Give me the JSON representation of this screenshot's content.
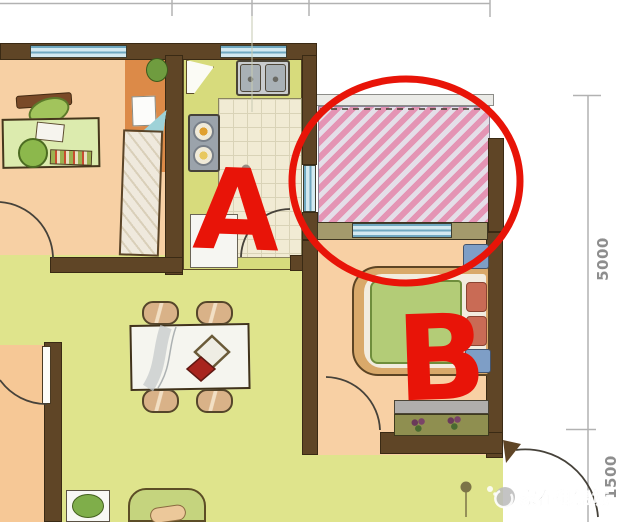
{
  "annotations": {
    "letter_a": "A",
    "letter_b": "B",
    "circle_color": "#e81408"
  },
  "dimensions": {
    "right_top": "5000",
    "right_bottom": "1500"
  },
  "watermark": {
    "icon": "camera-icon",
    "text": "家在御锦城"
  },
  "colors": {
    "wall_brown": "#5f4526",
    "window_blue": "#d3e9f0",
    "hatch_pink": "#e494b4",
    "study_floor": "#f7d0a4",
    "bedroom_floor": "#f8d0a4",
    "living_floor": "#dfe48c",
    "kitchen_counter": "#d7db7c",
    "annotation_red": "#e81408",
    "dimension_gray": "#8e8e8e"
  }
}
